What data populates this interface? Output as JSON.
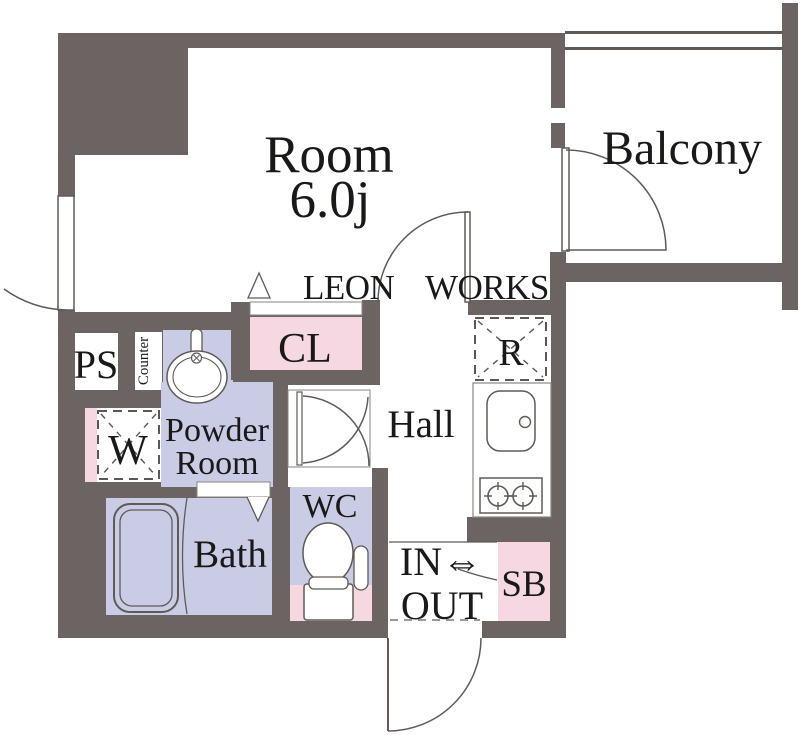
{
  "watermark": {
    "word1": "LEON",
    "word2": "WORKS"
  },
  "labels": {
    "room_name": "Room",
    "room_size": "6.0j",
    "balcony": "Balcony",
    "closet": "CL",
    "pipe_space": "PS",
    "counter": "Counter",
    "washer": "W",
    "powder_line1": "Powder",
    "powder_line2": "Room",
    "bath": "Bath",
    "wc": "WC",
    "hall": "Hall",
    "fridge": "R",
    "entrance_line1": "IN⇔",
    "entrance_line2": "OUT",
    "shoe_box": "SB"
  },
  "colors": {
    "wall": "#6b6462",
    "accent_pink": "#f5d8e1",
    "accent_lavender": "#c9cce4",
    "outline": "#5f5a57",
    "text": "#1b1918",
    "background": "#ffffff"
  }
}
